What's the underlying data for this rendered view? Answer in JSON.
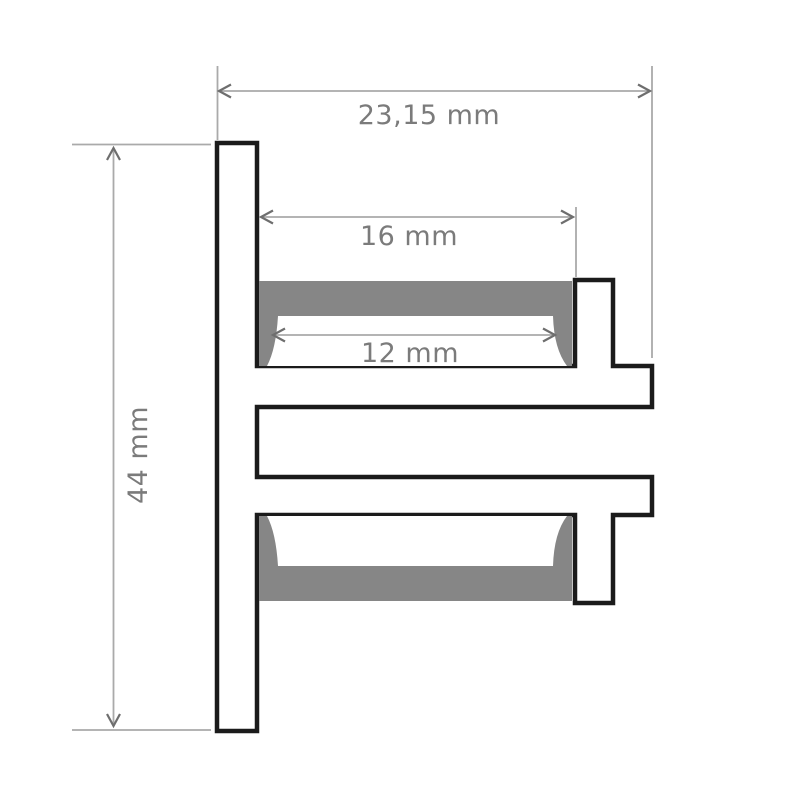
{
  "labels": {
    "overall_width": "23,15 mm",
    "channel_width": "16 mm",
    "lens_width": "12 mm",
    "overall_height": "44 mm"
  },
  "colors": {
    "background": "#ffffff",
    "outline": "#1b1b1b",
    "insert": "#868686",
    "lens": "#ffffff",
    "dim_line": "#aaaaaa",
    "dim_arrow": "#6e6e6e",
    "dim_text": "#7b7b7b"
  }
}
